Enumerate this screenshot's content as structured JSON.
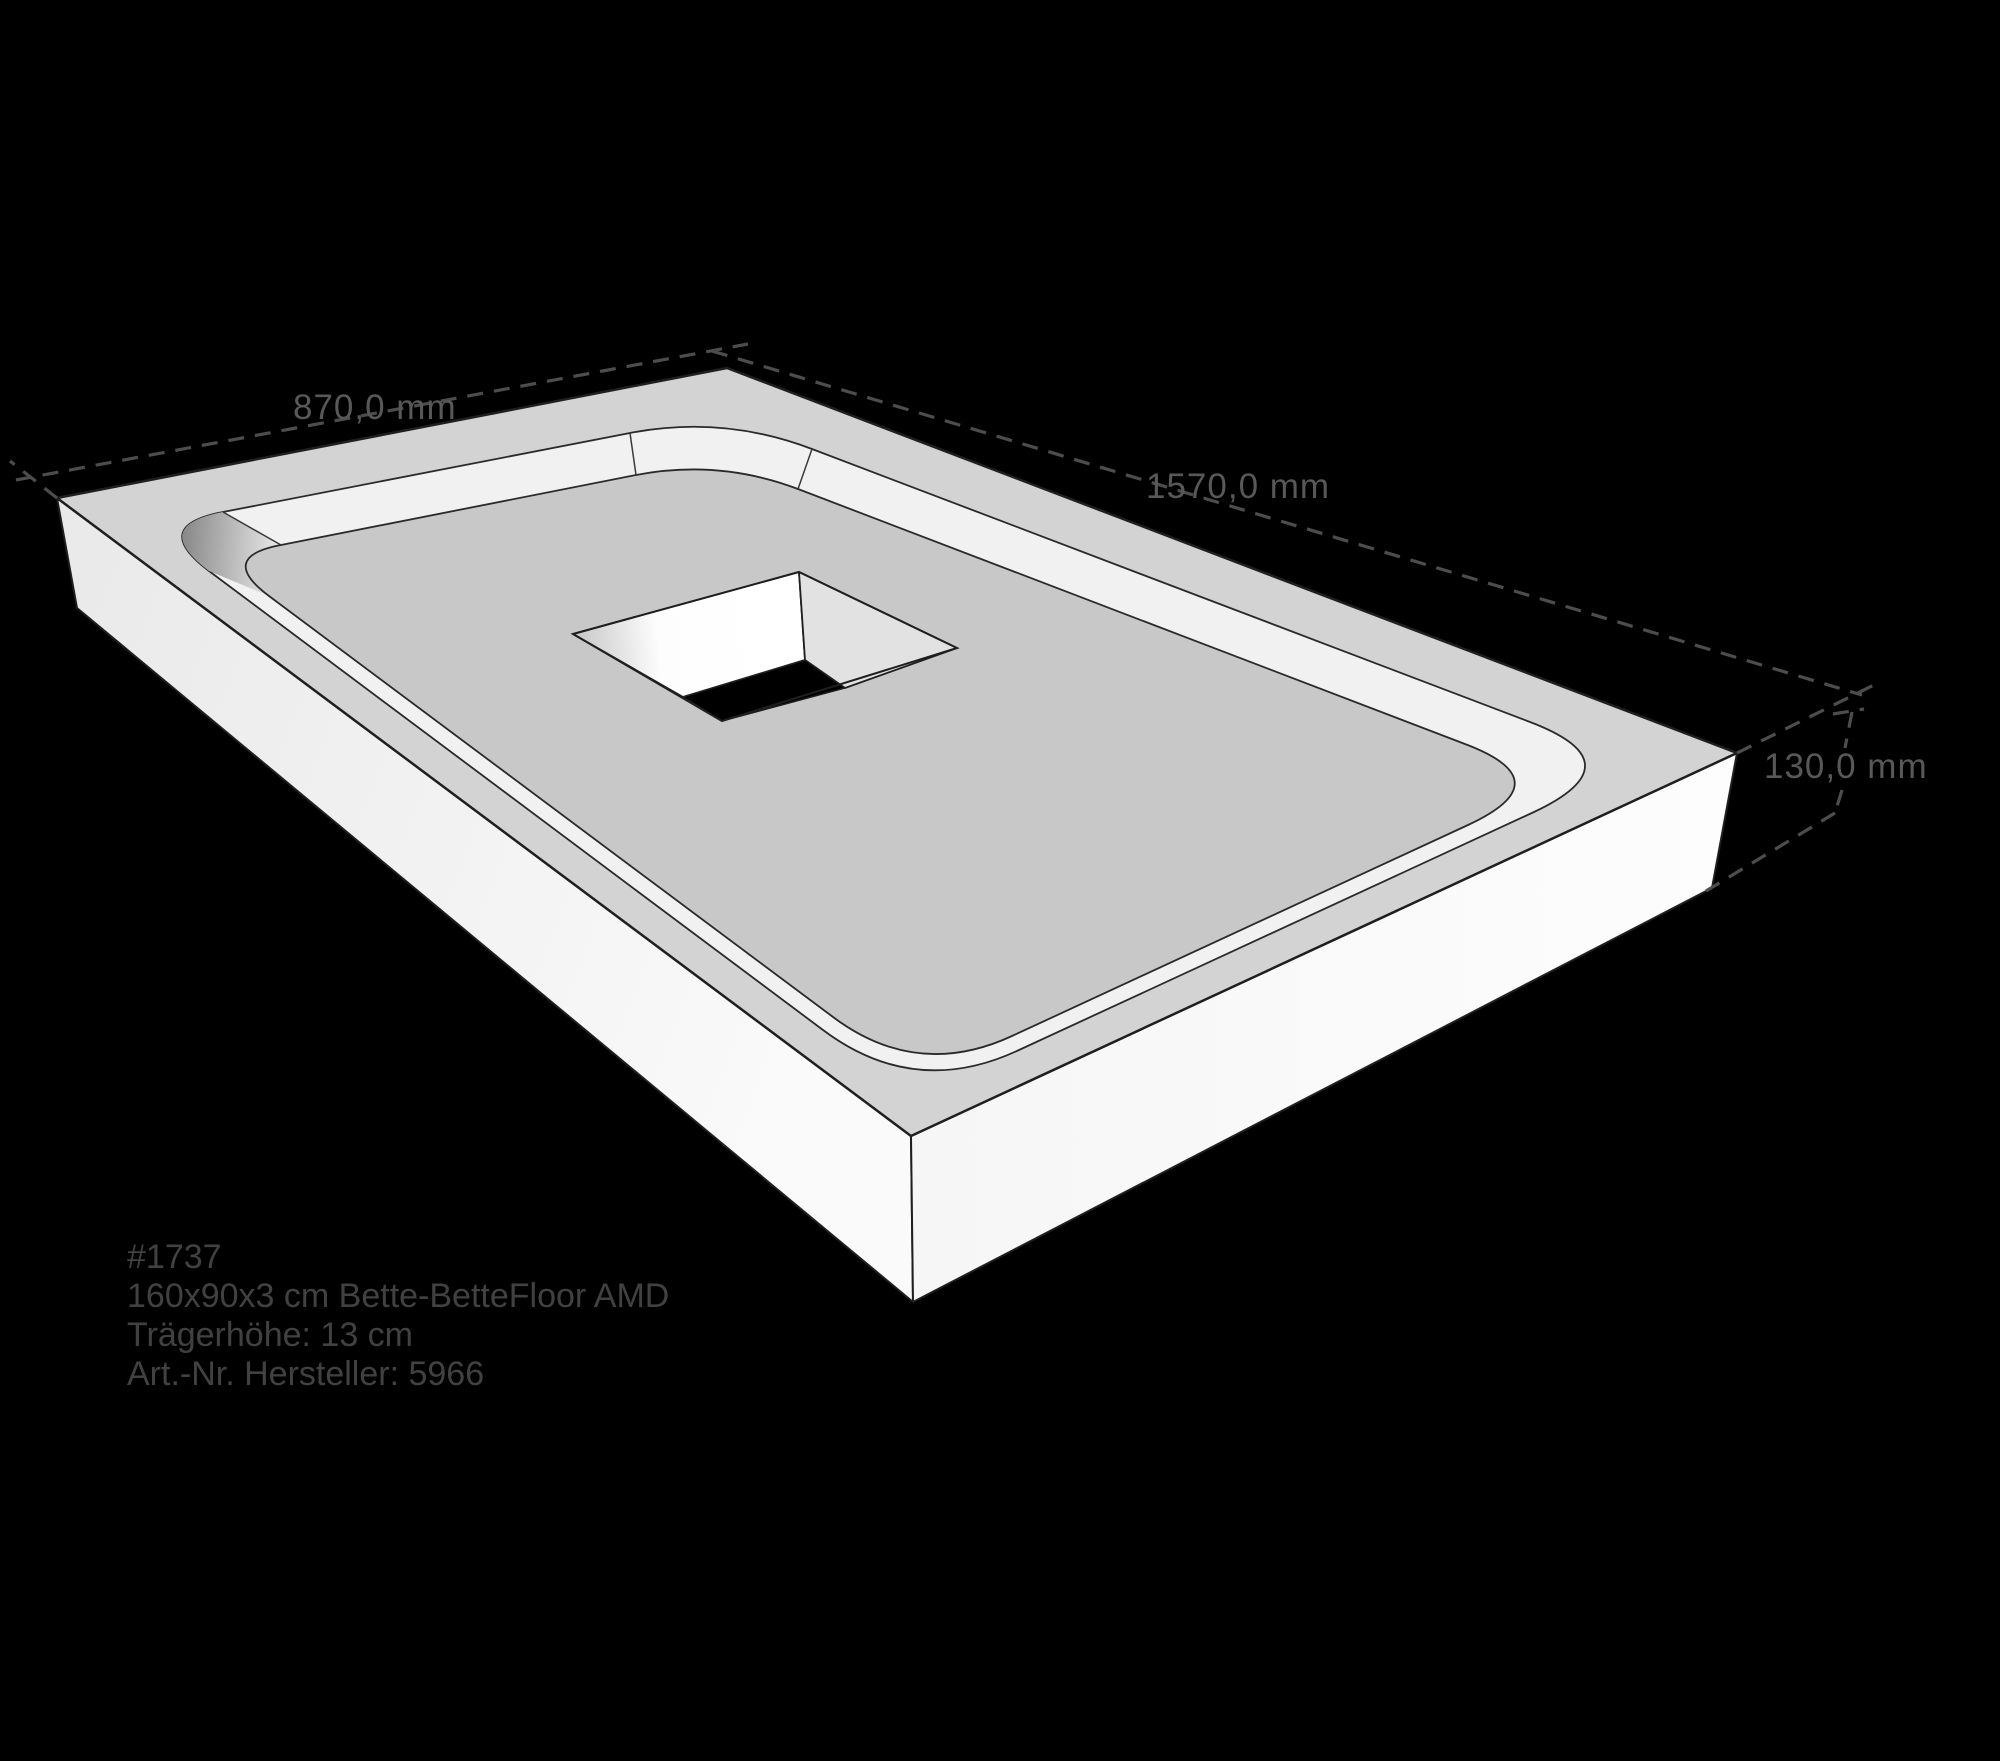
{
  "scene": {
    "type": "technical-3d-drawing",
    "subject": "shower-tray-support with central square drain cutout",
    "background_color": "#000000"
  },
  "dimensions": {
    "width_label": "870,0 mm",
    "length_label": "1570,0 mm",
    "height_label": "130,0 mm"
  },
  "info": {
    "line1": "#1737",
    "line2": "160x90x3 cm Bette-BetteFloor AMD",
    "line3": "Trägerhöhe: 13 cm",
    "line4": "Art.-Nr. Hersteller: 5966"
  },
  "colors": {
    "background": "#000000",
    "top_rim": "#d3d3d3",
    "recessed_floor": "#c8c8c8",
    "inner_wall": "#f1f1f1",
    "front_faces": "#f5f5f5",
    "hole_bottom": "#000000",
    "outline": "#1f1f1f",
    "dimension_lines": "#4d4d4d",
    "dimension_text": "#585858",
    "info_text": "#414141"
  }
}
